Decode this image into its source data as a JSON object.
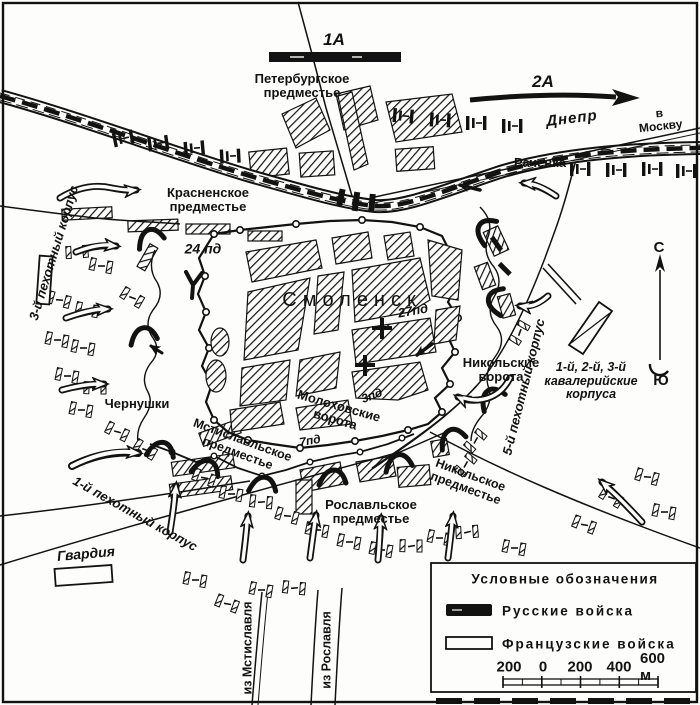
{
  "colors": {
    "ink": "#121212",
    "paper": "#fdfdfb"
  },
  "armies": {
    "army1": "1А",
    "army2": "2А"
  },
  "river": {
    "name": "Днепр",
    "to_moscow": "в Москву"
  },
  "places": {
    "petersburg": "Петербургское\nпредместье",
    "krasnenskoye": "Красненское\nпредместье",
    "rachevka": "Рачевка",
    "smolensk": "Смоленск",
    "chernushki": "Чернушки",
    "mstislavl_suburb": "Мстиславльское\nпредместье",
    "nikolskoye_suburb": "Никольское\nпредместье",
    "roslavl_suburb": "Рославльское\nпредместье"
  },
  "gates": {
    "nikolsky": "Никольские\nворота",
    "molokhov": "Молоховские\nворота"
  },
  "roads": {
    "from_mstislavl": "из Мстиславля",
    "from_roslavl": "из Рославля"
  },
  "units": {
    "corps3": "3-й пехотный корпус",
    "corps1": "1-й пехотный корпус",
    "corps5": "5-й пехотный корпус",
    "cavalry": "1-й, 2-й, 3-й\nкавалерийские\nкорпуса",
    "guard": "Гвардия",
    "div24": "24 пд",
    "div27": "27пд",
    "div3": "3пд",
    "div7": "7пд"
  },
  "compass": {
    "north": "С",
    "south": "Ю"
  },
  "legend": {
    "title": "Условные обозначения",
    "items": [
      {
        "name": "russian-troops",
        "label": "Русские войска"
      },
      {
        "name": "french-troops",
        "label": "Французские войска"
      }
    ],
    "scale_labels": [
      "200",
      "0",
      "200",
      "400",
      "600 м"
    ]
  }
}
